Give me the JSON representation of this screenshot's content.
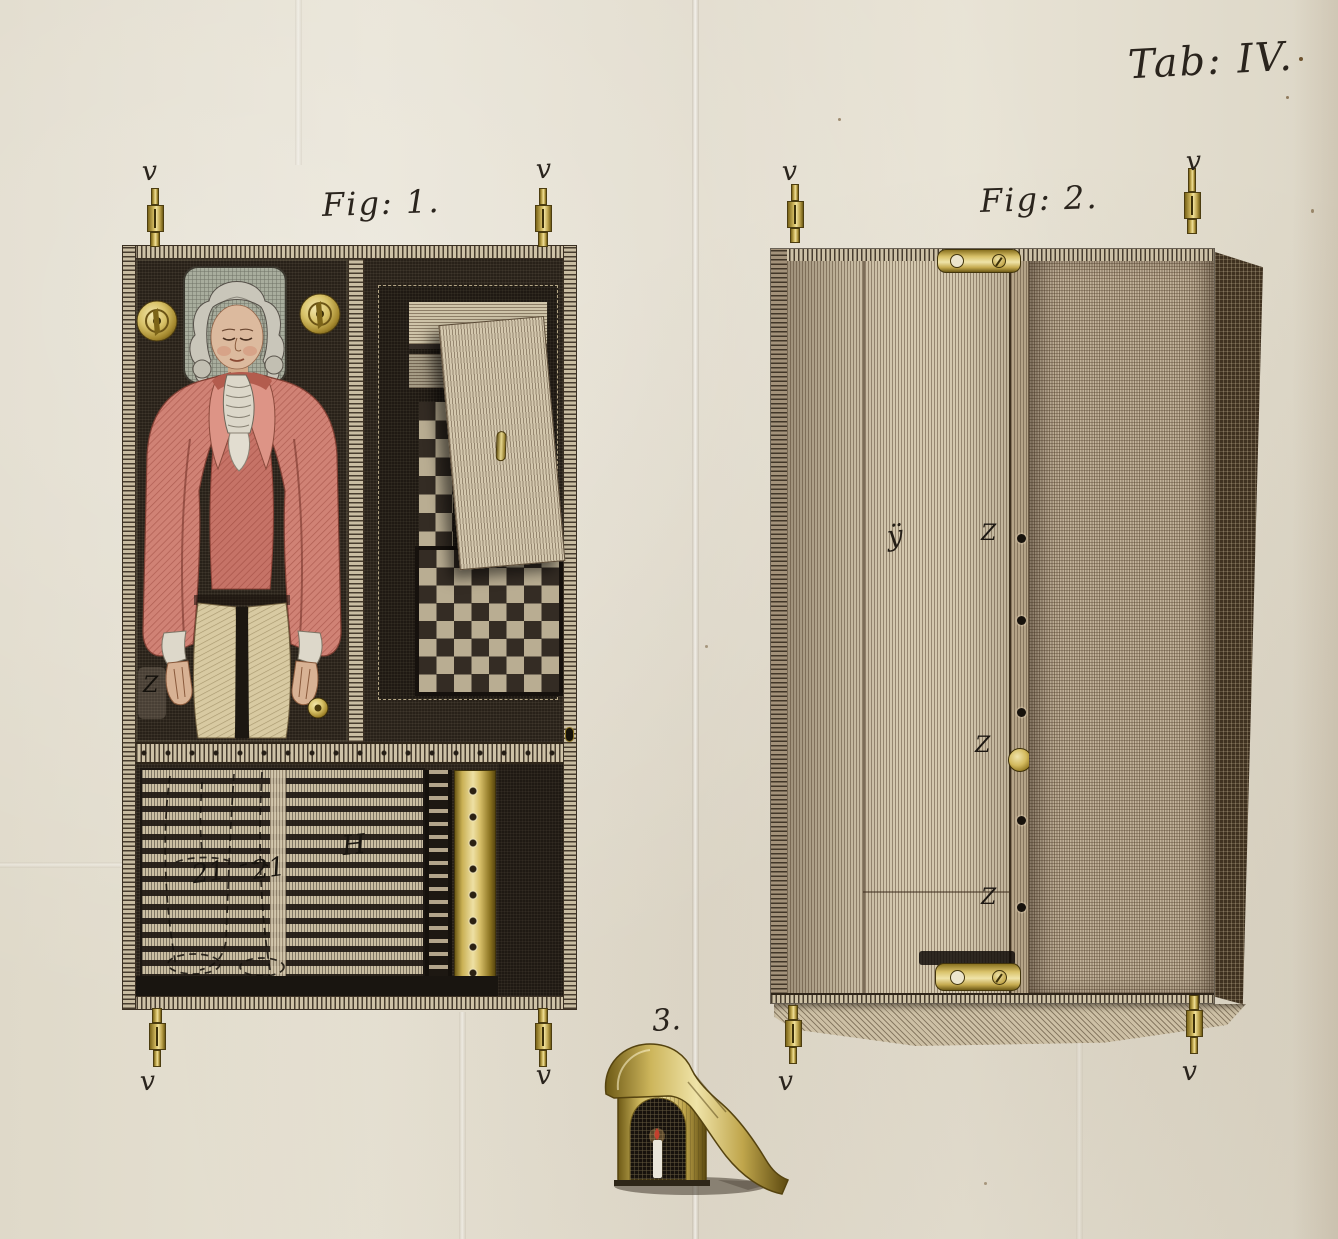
{
  "title": "Tab: IV.",
  "fig1": {
    "caption": "Fig: 1.",
    "hinge_label": "v",
    "interior_label": "Z",
    "drawer_labels": {
      "left": "21",
      "right": "21",
      "main": "H"
    }
  },
  "fig2": {
    "caption": "Fig: 2.",
    "hinge_label": "v",
    "door_label": "ÿ",
    "knob_labels": {
      "top": "Z",
      "middle": "Z",
      "bottom": "Z"
    }
  },
  "fig3": {
    "caption": "3."
  },
  "colors": {
    "paper": "#e4dfd0",
    "brass": "#c9ae55",
    "coat": "#cf8173",
    "dark_wood": "#282119"
  }
}
